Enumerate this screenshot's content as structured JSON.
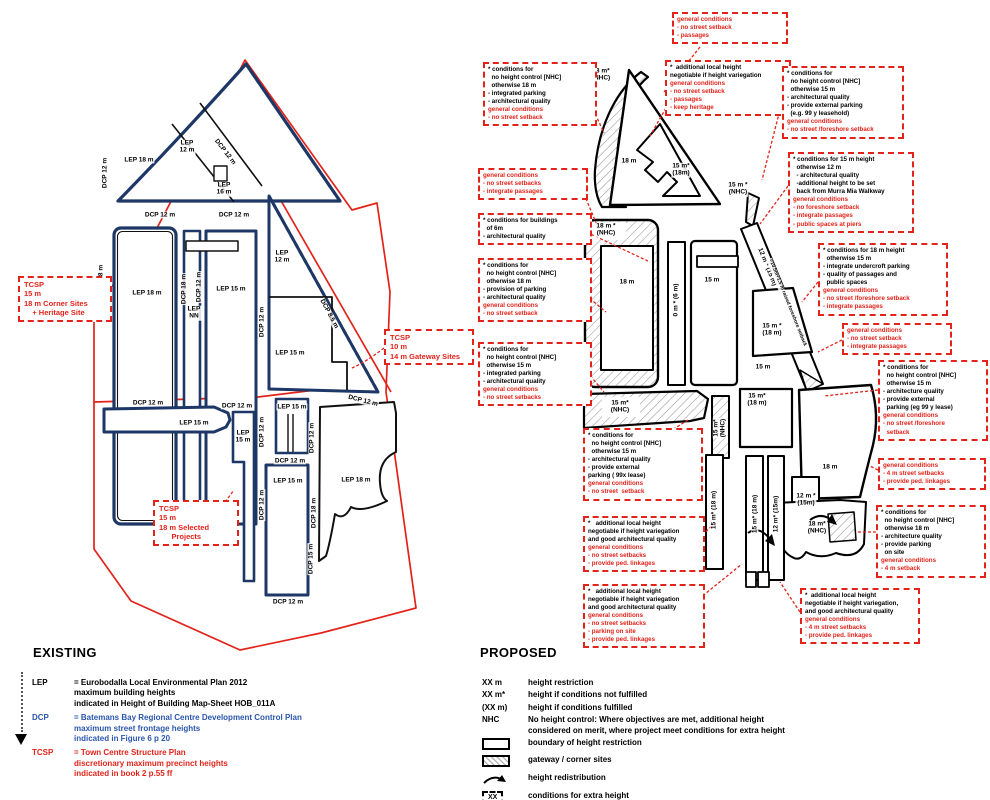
{
  "titles": {
    "existing": "EXISTING",
    "proposed": "PROPOSED"
  },
  "colors": {
    "red": "#e2231a",
    "navy": "#1d3766",
    "blue": "#2a56ad",
    "black": "#000000"
  },
  "existing_map": {
    "labels": [
      {
        "lines": [
          "DCP 12 m"
        ],
        "x": 105,
        "y": 173,
        "r": -90
      },
      {
        "lines": [
          "LEP 18 m"
        ],
        "x": 139,
        "y": 160
      },
      {
        "lines": [
          "LEP",
          "12 m"
        ],
        "x": 187,
        "y": 147
      },
      {
        "lines": [
          "DCP 12 m"
        ],
        "x": 225,
        "y": 152,
        "r": 52
      },
      {
        "lines": [
          "LEP",
          "16 m"
        ],
        "x": 224,
        "y": 189
      },
      {
        "lines": [
          "DCP 12 m"
        ],
        "x": 160,
        "y": 215
      },
      {
        "lines": [
          "DCP 12 m"
        ],
        "x": 234,
        "y": 215
      },
      {
        "lines": [
          "DCP 18 m"
        ],
        "x": 101,
        "y": 280,
        "r": -90
      },
      {
        "lines": [
          "LEP 18 m"
        ],
        "x": 147,
        "y": 293
      },
      {
        "lines": [
          "DCP 18 m"
        ],
        "x": 184,
        "y": 289,
        "r": -90
      },
      {
        "lines": [
          "DCP 12 m"
        ],
        "x": 199,
        "y": 287,
        "r": -90
      },
      {
        "lines": [
          "LEP 15 m"
        ],
        "x": 231,
        "y": 289
      },
      {
        "lines": [
          "LEP",
          "NN"
        ],
        "x": 194,
        "y": 313
      },
      {
        "lines": [
          "DCP 12 m"
        ],
        "x": 262,
        "y": 322,
        "r": -90
      },
      {
        "lines": [
          "LEP",
          "12 m"
        ],
        "x": 282,
        "y": 257
      },
      {
        "lines": [
          "DCP 8.5 m"
        ],
        "x": 329,
        "y": 314,
        "r": 62
      },
      {
        "lines": [
          "LEP 15 m"
        ],
        "x": 290,
        "y": 353
      },
      {
        "lines": [
          "DCP 12 m"
        ],
        "x": 148,
        "y": 403
      },
      {
        "lines": [
          "DCP 12 m"
        ],
        "x": 237,
        "y": 406
      },
      {
        "lines": [
          "DCP 12 m"
        ],
        "x": 363,
        "y": 401,
        "r": 14
      },
      {
        "lines": [
          "LEP 15 m"
        ],
        "x": 194,
        "y": 423
      },
      {
        "lines": [
          "LEP",
          "15 m"
        ],
        "x": 243,
        "y": 437
      },
      {
        "lines": [
          "LEP 15 m"
        ],
        "x": 292,
        "y": 407
      },
      {
        "lines": [
          "DCP 12 m"
        ],
        "x": 262,
        "y": 432,
        "r": -90
      },
      {
        "lines": [
          "DCP 12 m"
        ],
        "x": 290,
        "y": 461
      },
      {
        "lines": [
          "LEP 15 m"
        ],
        "x": 288,
        "y": 481
      },
      {
        "lines": [
          "DCP 12 m"
        ],
        "x": 262,
        "y": 505,
        "r": -90
      },
      {
        "lines": [
          "DCP 12 m"
        ],
        "x": 288,
        "y": 602
      },
      {
        "lines": [
          "DCP 12 m"
        ],
        "x": 312,
        "y": 438,
        "r": -90
      },
      {
        "lines": [
          "DCP 18 m"
        ],
        "x": 314,
        "y": 513,
        "r": -90
      },
      {
        "lines": [
          "DCP 15 m"
        ],
        "x": 311,
        "y": 559,
        "r": -90
      },
      {
        "lines": [
          "LEP 18 m"
        ],
        "x": 356,
        "y": 480
      }
    ],
    "tcsp_boxes": [
      {
        "x": 18,
        "y": 276,
        "w": 82,
        "lines": [
          "TCSP",
          "15 m",
          "18 m Corner Sites",
          "    + Heritage Site"
        ]
      },
      {
        "x": 384,
        "y": 329,
        "w": 78,
        "lines": [
          "TCSP",
          "10 m",
          "14 m Gateway Sites"
        ]
      },
      {
        "x": 153,
        "y": 500,
        "w": 74,
        "lines": [
          "TCSP",
          "15 m",
          "18 m Selected",
          "      Projects"
        ]
      }
    ]
  },
  "proposed_map": {
    "labels": [
      {
        "lines": [
          "18 m*",
          "(NHC)"
        ],
        "x": 601,
        "y": 75
      },
      {
        "lines": [
          "18 m"
        ],
        "x": 629,
        "y": 161
      },
      {
        "lines": [
          "15 m*",
          "(18m)"
        ],
        "x": 681,
        "y": 170
      },
      {
        "lines": [
          "15 m *",
          "(NHC)"
        ],
        "x": 738,
        "y": 189
      },
      {
        "lines": [
          "18 m *",
          "(NHC)"
        ],
        "x": 606,
        "y": 230
      },
      {
        "lines": [
          "18 m"
        ],
        "x": 627,
        "y": 282
      },
      {
        "lines": [
          "0 m * (6 m)"
        ],
        "x": 676,
        "y": 300,
        "r": -90
      },
      {
        "lines": [
          "15 m"
        ],
        "x": 712,
        "y": 280
      },
      {
        "lines": [
          "12 m * (15 m)"
        ],
        "x": 767,
        "y": 267,
        "r": 68
      },
      {
        "lines": [
          "=10.5m+1.5 m raised foreshore setback"
        ],
        "x": 787,
        "y": 303,
        "r": 68,
        "small": true
      },
      {
        "lines": [
          "15 m *",
          "(18 m)"
        ],
        "x": 772,
        "y": 330
      },
      {
        "lines": [
          "15 m"
        ],
        "x": 763,
        "y": 367
      },
      {
        "lines": [
          "15 m*",
          "(NHC)"
        ],
        "x": 620,
        "y": 407
      },
      {
        "lines": [
          "15 m*",
          "(NHC)"
        ],
        "x": 720,
        "y": 428,
        "r": -90
      },
      {
        "lines": [
          "15 m*",
          "(18 m)"
        ],
        "x": 757,
        "y": 400
      },
      {
        "lines": [
          "18 m"
        ],
        "x": 830,
        "y": 467
      },
      {
        "lines": [
          "12 m *",
          "(15m)"
        ],
        "x": 806,
        "y": 500
      },
      {
        "lines": [
          "18 m*",
          "(NHC)"
        ],
        "x": 817,
        "y": 528
      },
      {
        "lines": [
          "15 m* (18 m)"
        ],
        "x": 714,
        "y": 510,
        "r": -90
      },
      {
        "lines": [
          "15 m* (18 m)"
        ],
        "x": 755,
        "y": 514,
        "r": -90
      },
      {
        "lines": [
          "12 m* (15m)"
        ],
        "x": 776,
        "y": 514,
        "r": -90
      }
    ],
    "condition_boxes": [
      {
        "x": 672,
        "y": 12,
        "w": 106,
        "black": [],
        "red": [
          "general conditions",
          "- no street setback",
          "- passages"
        ]
      },
      {
        "x": 483,
        "y": 62,
        "w": 104,
        "black": [
          "* conditions for",
          "  no height control [NHC]",
          "  otherwise 18 m",
          "- integrated parking",
          "- architectural quality"
        ],
        "red": [
          "general conditions",
          "- no street setback"
        ]
      },
      {
        "x": 665,
        "y": 60,
        "w": 116,
        "black": [
          "*  additional local height",
          "negotiable if height variegation"
        ],
        "red": [
          "general conditions",
          "- no street setback",
          "- passages",
          "- keep heritage"
        ]
      },
      {
        "x": 782,
        "y": 66,
        "w": 112,
        "black": [
          "* conditions for",
          "  no height control [NHC]",
          "  otherwise 15 m",
          "- architectural quality",
          "- provide external parking",
          "  (e.g. 99 y leasehold)"
        ],
        "red": [
          "general conditions",
          "- no street /foreshore setback"
        ]
      },
      {
        "x": 788,
        "y": 152,
        "w": 116,
        "black": [
          "* conditions for 15 m height",
          "  otherwise 12 m",
          "  - architectural quality",
          "  -additional height to be set",
          "  back from Murra Mia Walkway"
        ],
        "red": [
          "general conditions",
          "- no foreshore setback",
          "- integrate passages",
          "- public spaces at piers"
        ]
      },
      {
        "x": 818,
        "y": 243,
        "w": 120,
        "black": [
          "* conditions for 18 m height",
          "  otherwise 15 m",
          "- integrate undercroft parking",
          "- quality of passages and",
          "  public spaces"
        ],
        "red": [
          "general conditions",
          "- no street /foreshore setback",
          "- integrate passages"
        ]
      },
      {
        "x": 842,
        "y": 323,
        "w": 100,
        "black": [],
        "red": [
          "general conditions",
          "- no street setback",
          "- integrate passages"
        ]
      },
      {
        "x": 878,
        "y": 360,
        "w": 100,
        "black": [
          "* conditions for",
          "  no height control [NHC]",
          "  otherwise 15 m",
          "- architecture quality",
          "- provide external",
          "  parking (eg 99 y lease)"
        ],
        "red": [
          "general conditions",
          "- no street /foreshore",
          "  setback"
        ]
      },
      {
        "x": 878,
        "y": 458,
        "w": 98,
        "black": [],
        "red": [
          "general conditions",
          "- 4 m street setbacks",
          "- provide ped. linkages"
        ]
      },
      {
        "x": 876,
        "y": 505,
        "w": 100,
        "black": [
          "* conditions for",
          "  no height control [NHC]",
          "  otherwise 18 m",
          "- architecture quality",
          "- provide parking",
          "  on site"
        ],
        "red": [
          "general conditions",
          "- 4 m setback"
        ]
      },
      {
        "x": 800,
        "y": 588,
        "w": 110,
        "black": [
          "*  additional local height",
          "negotiable if height variegation,",
          "and good architectural quality"
        ],
        "red": [
          "general conditions",
          "- 4 m street setbacks",
          "- provide ped. linkages"
        ]
      },
      {
        "x": 478,
        "y": 168,
        "w": 100,
        "black": [],
        "red": [
          "general conditions",
          "- no street setbacks",
          "- integrate passages"
        ]
      },
      {
        "x": 478,
        "y": 213,
        "w": 104,
        "black": [
          "* conditions for buildings",
          "  of 6m",
          "- architectural quality"
        ],
        "red": []
      },
      {
        "x": 478,
        "y": 258,
        "w": 104,
        "black": [
          "* conditions for",
          "  no height control [NHC]",
          "  otherwise 18 m",
          "- provision of parking",
          "- architectural quality"
        ],
        "red": [
          "general conditions",
          "- no street setback"
        ]
      },
      {
        "x": 478,
        "y": 342,
        "w": 104,
        "black": [
          "* conditions for",
          "  no height control [NHC]",
          "  otherwise 15 m",
          "- integrated parking",
          "- architectural quality"
        ],
        "red": [
          "general conditions",
          "- no street setbacks"
        ]
      },
      {
        "x": 583,
        "y": 428,
        "w": 110,
        "black": [
          "* conditions for",
          "  no height control [NHC]",
          "  otherwise 15 m",
          "- architectural quality",
          "- provide external",
          "parking ( 99x lease)"
        ],
        "red": [
          "general conditions",
          "- no street  setback"
        ]
      },
      {
        "x": 583,
        "y": 516,
        "w": 112,
        "black": [
          "*   additional local height",
          "negotiable if height variegation",
          "and good architectural quality"
        ],
        "red": [
          "general conditions",
          "- no street setbacks",
          "- provide ped. linkages"
        ]
      },
      {
        "x": 583,
        "y": 584,
        "w": 112,
        "black": [
          "*   additional local height",
          "negotiable if height variegation",
          "and good architectural quality"
        ],
        "red": [
          "general conditions",
          "- no street setbacks",
          "- parking on site",
          "- provide ped. linkages"
        ]
      }
    ]
  },
  "existing_legend": {
    "items": [
      {
        "abbr": "LEP",
        "color": "black",
        "lines": [
          "= Eurobodalla Local Environmental Plan 2012",
          "maximum building heights",
          "indicated in Height of Building Map-Sheet HOB_011A"
        ]
      },
      {
        "abbr": "DCP",
        "color": "blue",
        "lines": [
          "= Batemans Bay Regional Centre Development Control Plan",
          "maximum street frontage heights",
          "indicated in Figure 6 p 20"
        ]
      },
      {
        "abbr": "TCSP",
        "color": "red",
        "lines": [
          "= Town Centre Structure Plan",
          "discretionary maximum precinct heights",
          "indicated in book 2 p.55 ff"
        ]
      }
    ]
  },
  "proposed_legend": {
    "items": [
      {
        "sym": "XX m",
        "icon": "text",
        "lines": [
          "height restriction"
        ]
      },
      {
        "sym": "XX m*",
        "icon": "text",
        "lines": [
          "height if conditions not fulfilled"
        ]
      },
      {
        "sym": "(XX m)",
        "icon": "text",
        "lines": [
          "height if conditions fulfilled"
        ]
      },
      {
        "sym": "NHC",
        "icon": "text",
        "lines": [
          "No height control: Where objectives are met, additional height",
          "considered on merit, where project meet conditions for extra height"
        ]
      },
      {
        "icon": "rect",
        "lines": [
          "boundary of height restriction"
        ]
      },
      {
        "icon": "hatch",
        "lines": [
          "gateway / corner sites"
        ]
      },
      {
        "icon": "arrow",
        "lines": [
          "height redistribution"
        ]
      },
      {
        "icon": "dash",
        "sym": "XX",
        "lines": [
          "conditions for extra height"
        ]
      },
      {
        "icon": "dash-red",
        "sym": "XX",
        "lines": [
          "general conditions"
        ],
        "red": true
      }
    ]
  }
}
